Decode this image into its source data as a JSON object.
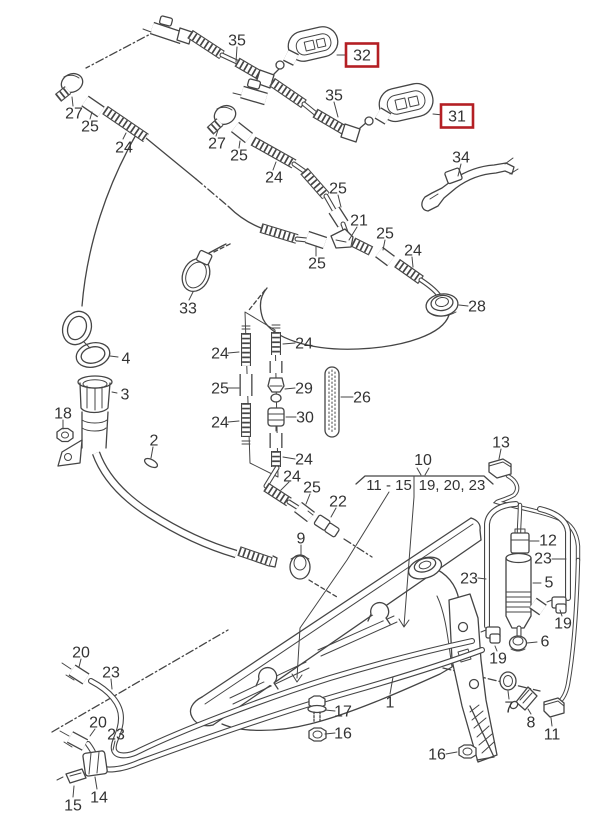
{
  "figure": {
    "kind": "exploded-parts-diagram",
    "subject": "Windshield washer reservoir, pump, hoses and heated spray nozzles",
    "background_color": "#ffffff",
    "line_color": "#454545",
    "label_color": "#333333",
    "highlight_color": "#b41f24"
  },
  "group_bracket": {
    "number": "10",
    "left_range": "11 - 15",
    "right_range": "19, 20, 23"
  },
  "callouts": [
    {
      "label": "27",
      "x": 74,
      "y": 113,
      "highlighted": false
    },
    {
      "label": "25",
      "x": 90,
      "y": 126,
      "highlighted": false
    },
    {
      "label": "24",
      "x": 124,
      "y": 147,
      "highlighted": false
    },
    {
      "label": "35",
      "x": 237,
      "y": 40,
      "highlighted": false
    },
    {
      "label": "32",
      "x": 362,
      "y": 55,
      "highlighted": true
    },
    {
      "label": "27",
      "x": 217,
      "y": 143,
      "highlighted": false
    },
    {
      "label": "25",
      "x": 239,
      "y": 155,
      "highlighted": false
    },
    {
      "label": "24",
      "x": 274,
      "y": 177,
      "highlighted": false
    },
    {
      "label": "35",
      "x": 334,
      "y": 95,
      "highlighted": false
    },
    {
      "label": "31",
      "x": 457,
      "y": 116,
      "highlighted": true
    },
    {
      "label": "34",
      "x": 461,
      "y": 157,
      "highlighted": false
    },
    {
      "label": "25",
      "x": 338,
      "y": 188,
      "highlighted": false
    },
    {
      "label": "21",
      "x": 359,
      "y": 220,
      "highlighted": false
    },
    {
      "label": "25",
      "x": 385,
      "y": 233,
      "highlighted": false
    },
    {
      "label": "24",
      "x": 413,
      "y": 250,
      "highlighted": false
    },
    {
      "label": "25",
      "x": 317,
      "y": 263,
      "highlighted": false
    },
    {
      "label": "33",
      "x": 188,
      "y": 308,
      "highlighted": false
    },
    {
      "label": "28",
      "x": 477,
      "y": 306,
      "highlighted": false
    },
    {
      "label": "4",
      "x": 126,
      "y": 358,
      "highlighted": false
    },
    {
      "label": "3",
      "x": 125,
      "y": 394,
      "highlighted": false
    },
    {
      "label": "18",
      "x": 63,
      "y": 413,
      "highlighted": false
    },
    {
      "label": "2",
      "x": 154,
      "y": 440,
      "highlighted": false
    },
    {
      "label": "24",
      "x": 220,
      "y": 353,
      "highlighted": false
    },
    {
      "label": "25",
      "x": 220,
      "y": 388,
      "highlighted": false
    },
    {
      "label": "24",
      "x": 220,
      "y": 422,
      "highlighted": false
    },
    {
      "label": "24",
      "x": 304,
      "y": 343,
      "highlighted": false
    },
    {
      "label": "29",
      "x": 304,
      "y": 388,
      "highlighted": false
    },
    {
      "label": "30",
      "x": 305,
      "y": 417,
      "highlighted": false
    },
    {
      "label": "26",
      "x": 362,
      "y": 397,
      "highlighted": false
    },
    {
      "label": "24",
      "x": 304,
      "y": 459,
      "highlighted": false
    },
    {
      "label": "24",
      "x": 292,
      "y": 476,
      "highlighted": false
    },
    {
      "label": "25",
      "x": 312,
      "y": 487,
      "highlighted": false
    },
    {
      "label": "22",
      "x": 338,
      "y": 501,
      "highlighted": false
    },
    {
      "label": "9",
      "x": 301,
      "y": 538,
      "highlighted": false
    },
    {
      "label": "13",
      "x": 501,
      "y": 442,
      "highlighted": false
    },
    {
      "label": "12",
      "x": 548,
      "y": 540,
      "highlighted": false
    },
    {
      "label": "23",
      "x": 543,
      "y": 558,
      "highlighted": false
    },
    {
      "label": "23",
      "x": 469,
      "y": 578,
      "highlighted": false
    },
    {
      "label": "5",
      "x": 549,
      "y": 582,
      "highlighted": false
    },
    {
      "label": "19",
      "x": 563,
      "y": 623,
      "highlighted": false
    },
    {
      "label": "6",
      "x": 545,
      "y": 641,
      "highlighted": false
    },
    {
      "label": "19",
      "x": 498,
      "y": 658,
      "highlighted": false
    },
    {
      "label": "7",
      "x": 509,
      "y": 707,
      "highlighted": false
    },
    {
      "label": "8",
      "x": 531,
      "y": 722,
      "highlighted": false
    },
    {
      "label": "11",
      "x": 552,
      "y": 734,
      "highlighted": false
    },
    {
      "label": "16",
      "x": 437,
      "y": 754,
      "highlighted": false
    },
    {
      "label": "1",
      "x": 390,
      "y": 702,
      "highlighted": false
    },
    {
      "label": "17",
      "x": 343,
      "y": 711,
      "highlighted": false
    },
    {
      "label": "16",
      "x": 343,
      "y": 733,
      "highlighted": false
    },
    {
      "label": "20",
      "x": 81,
      "y": 652,
      "highlighted": false
    },
    {
      "label": "23",
      "x": 111,
      "y": 672,
      "highlighted": false
    },
    {
      "label": "20",
      "x": 98,
      "y": 722,
      "highlighted": false
    },
    {
      "label": "23",
      "x": 116,
      "y": 734,
      "highlighted": false
    },
    {
      "label": "14",
      "x": 99,
      "y": 797,
      "highlighted": false
    },
    {
      "label": "15",
      "x": 73,
      "y": 805,
      "highlighted": false
    }
  ]
}
